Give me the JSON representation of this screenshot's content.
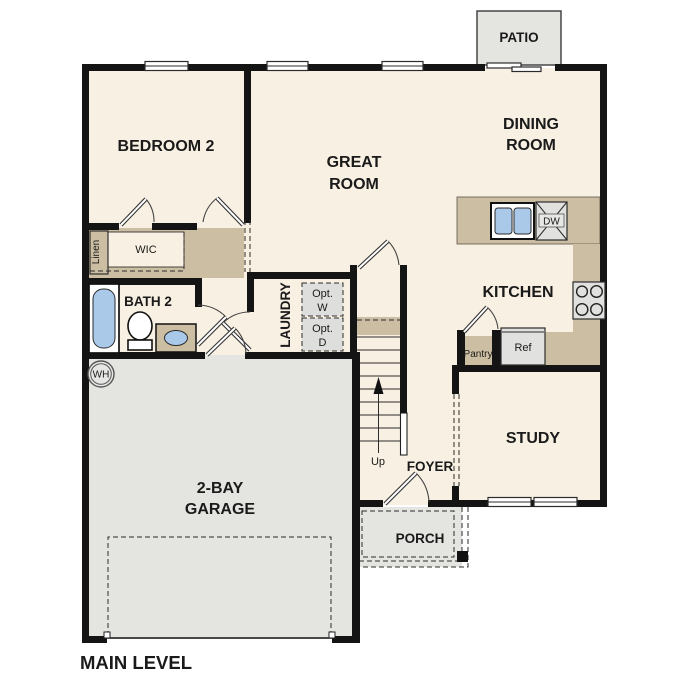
{
  "title": "MAIN LEVEL",
  "labels": {
    "patio": "PATIO",
    "bedroom2": "BEDROOM 2",
    "great_room": [
      "GREAT",
      "ROOM"
    ],
    "dining_room": [
      "DINING",
      "ROOM"
    ],
    "kitchen": "KITCHEN",
    "study": "STUDY",
    "foyer": "FOYER",
    "porch": "PORCH",
    "garage": [
      "2-BAY",
      "GARAGE"
    ],
    "bath2": "BATH 2",
    "wic": "WIC",
    "linen": "Linen",
    "laundry": "LAUNDRY",
    "opt_washer": [
      "Opt.",
      "W"
    ],
    "opt_dryer": [
      "Opt.",
      "D"
    ],
    "up": "Up",
    "dw": "DW",
    "ref": "Ref",
    "pantry": "Pantry",
    "wh": "WH"
  },
  "colors": {
    "wall": "#141414",
    "floor": "#f8f0e2",
    "concrete": "#e4e4e1",
    "counter": "#ccbea2",
    "appliance": "#e1e1df",
    "water": "#aac9e9",
    "line": "#2b2b2b",
    "text": "#1a1a1a"
  }
}
